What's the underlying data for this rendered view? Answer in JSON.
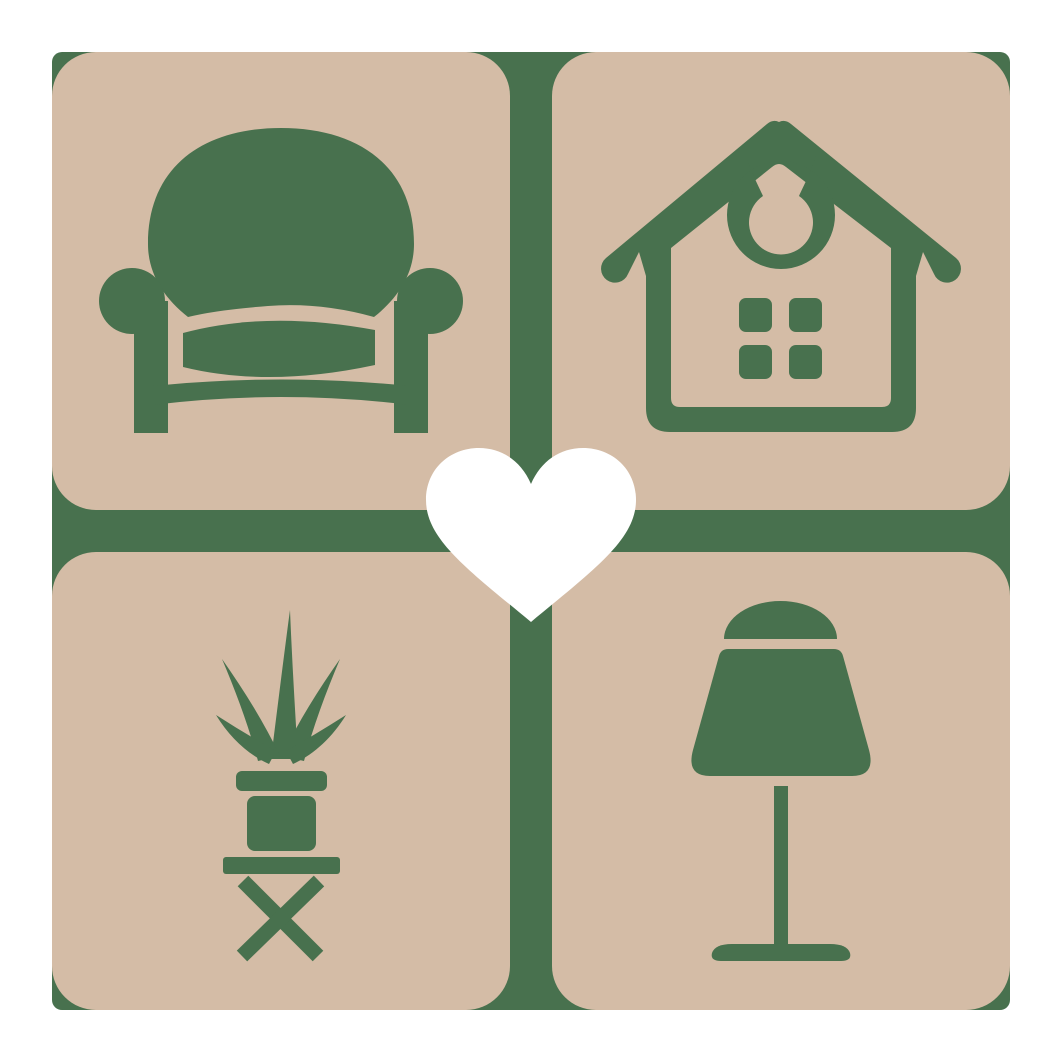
{
  "colors": {
    "canvas": "#ffffff",
    "tile": "#d4bca6",
    "green": "#48714e",
    "heart": "#ffffff"
  },
  "logo": {
    "backdrop": "green-rounded-square",
    "tiles": [
      {
        "position": "top-left",
        "icon": "armchair-icon"
      },
      {
        "position": "top-right",
        "icon": "house-icon"
      },
      {
        "position": "bottom-left",
        "icon": "potted-plant-icon"
      },
      {
        "position": "bottom-right",
        "icon": "table-lamp-icon"
      }
    ],
    "center_icon": "heart-icon"
  }
}
